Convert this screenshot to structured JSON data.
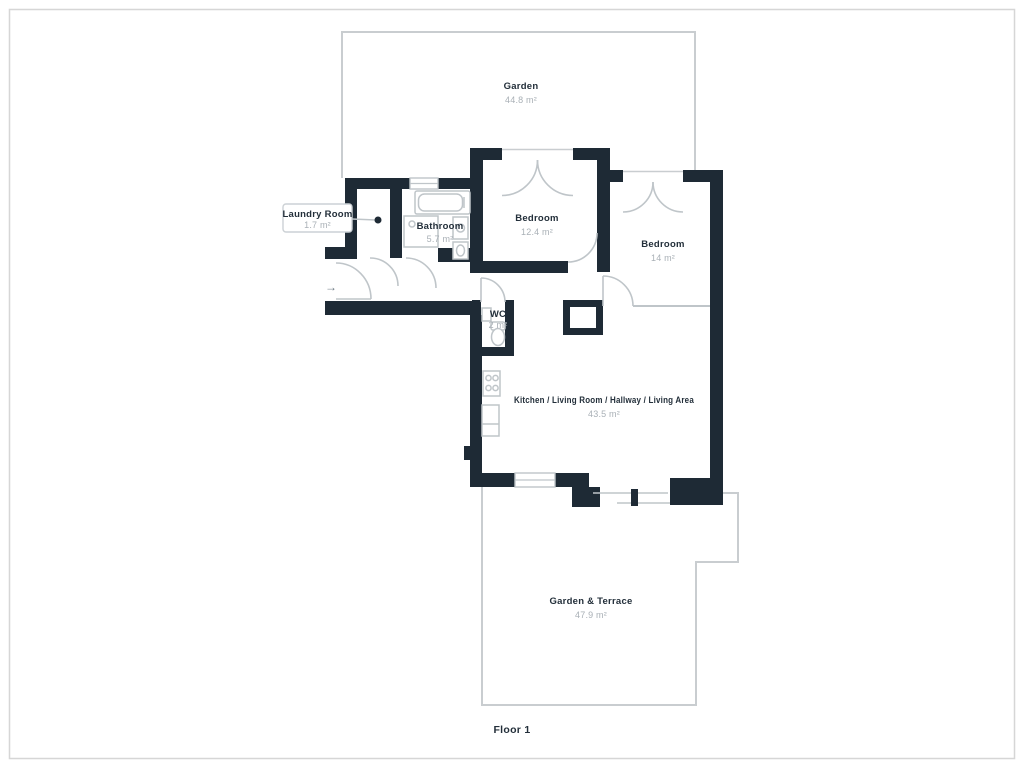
{
  "floorplan": {
    "floor_label": "Floor 1",
    "entrance_arrow_icon": "→",
    "rooms": [
      {
        "name": "Garden",
        "area": "44.8 m²"
      },
      {
        "name": "Laundry Room",
        "area": "1.7 m²"
      },
      {
        "name": "Bathroom",
        "area": "5.7 m²"
      },
      {
        "name": "Bedroom",
        "area": "12.4 m²"
      },
      {
        "name": "Bedroom",
        "area": "14 m²"
      },
      {
        "name": "WC",
        "area": "2 m²"
      },
      {
        "name": "Kitchen / Living Room / Hallway / Living Area",
        "area": "43.5 m²"
      },
      {
        "name": "Garden & Terrace",
        "area": "47.9 m²"
      }
    ],
    "colors": {
      "wall": "#1e2a35",
      "outline": "#c9cdd0",
      "thin_line": "#bfc5c9",
      "room_name_text": "#232f3a",
      "area_text": "#a9b0b6",
      "frame": "#d6d6d6"
    }
  }
}
